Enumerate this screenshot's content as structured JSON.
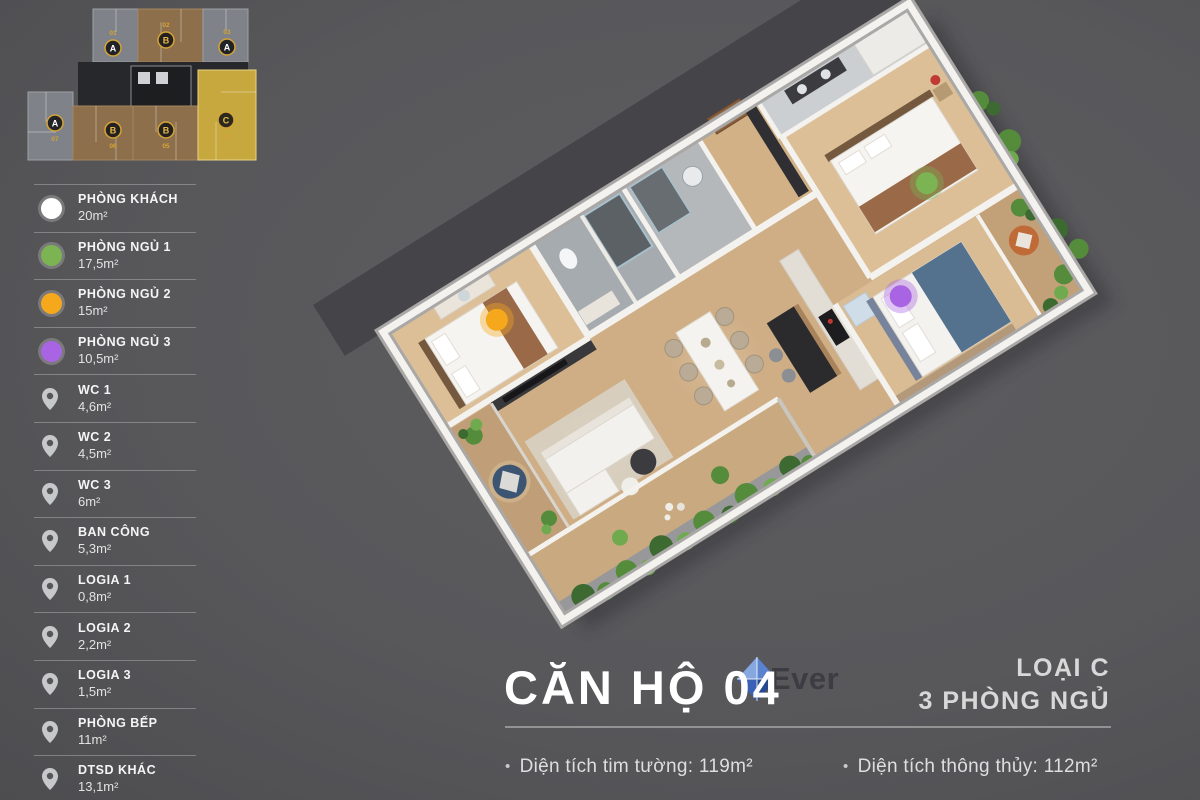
{
  "app": {
    "background": "#58585b"
  },
  "minimap": {
    "accent": "#d4a437",
    "highlight_unit": "04",
    "units": [
      {
        "letter": "A",
        "number": "01"
      },
      {
        "letter": "B",
        "number": "02"
      },
      {
        "letter": "A",
        "number": "03"
      },
      {
        "letter": "A",
        "number": "07"
      },
      {
        "letter": "B",
        "number": "06"
      },
      {
        "letter": "B",
        "number": "05"
      },
      {
        "letter": "C",
        "number": "04"
      }
    ]
  },
  "legend": {
    "items": [
      {
        "icon": "circle",
        "color": "#ffffff",
        "label": "PHÒNG KHÁCH",
        "area": "20m²"
      },
      {
        "icon": "circle",
        "color": "#7cb353",
        "label": "PHÒNG NGỦ 1",
        "area": "17,5m²"
      },
      {
        "icon": "circle",
        "color": "#f6a81d",
        "label": "PHÒNG NGỦ 2",
        "area": "15m²"
      },
      {
        "icon": "circle",
        "color": "#a964e3",
        "label": "PHÒNG NGỦ 3",
        "area": "10,5m²"
      },
      {
        "icon": "pin",
        "label": "WC 1",
        "area": "4,6m²"
      },
      {
        "icon": "pin",
        "label": "WC 2",
        "area": "4,5m²"
      },
      {
        "icon": "pin",
        "label": "WC 3",
        "area": "6m²"
      },
      {
        "icon": "pin",
        "label": "BAN CÔNG",
        "area": "5,3m²"
      },
      {
        "icon": "pin",
        "label": "LOGIA 1",
        "area": "0,8m²"
      },
      {
        "icon": "pin",
        "label": "LOGIA 2",
        "area": "2,2m²"
      },
      {
        "icon": "pin",
        "label": "LOGIA 3",
        "area": "1,5m²"
      },
      {
        "icon": "pin",
        "label": "PHÒNG BẾP",
        "area": "11m²"
      },
      {
        "icon": "pin",
        "label": "DTSD KHÁC",
        "area": "13,1m²"
      }
    ]
  },
  "plan": {
    "dots": [
      {
        "room": "PHÒNG NGỦ 2",
        "color": "#f6a81d"
      },
      {
        "room": "PHÒNG NGỦ 1",
        "color": "#7cb353"
      },
      {
        "room": "PHÒNG NGỦ 3",
        "color": "#a964e3"
      }
    ]
  },
  "footer": {
    "title": "CĂN HỘ 04",
    "type_label": "LOẠI C",
    "bedrooms_label": "3 PHÒNG NGỦ",
    "stat_wall": "Diện tích tim tường: 119m²",
    "stat_clear": "Diện tích thông thủy: 112m²",
    "watermark": "Ever"
  }
}
